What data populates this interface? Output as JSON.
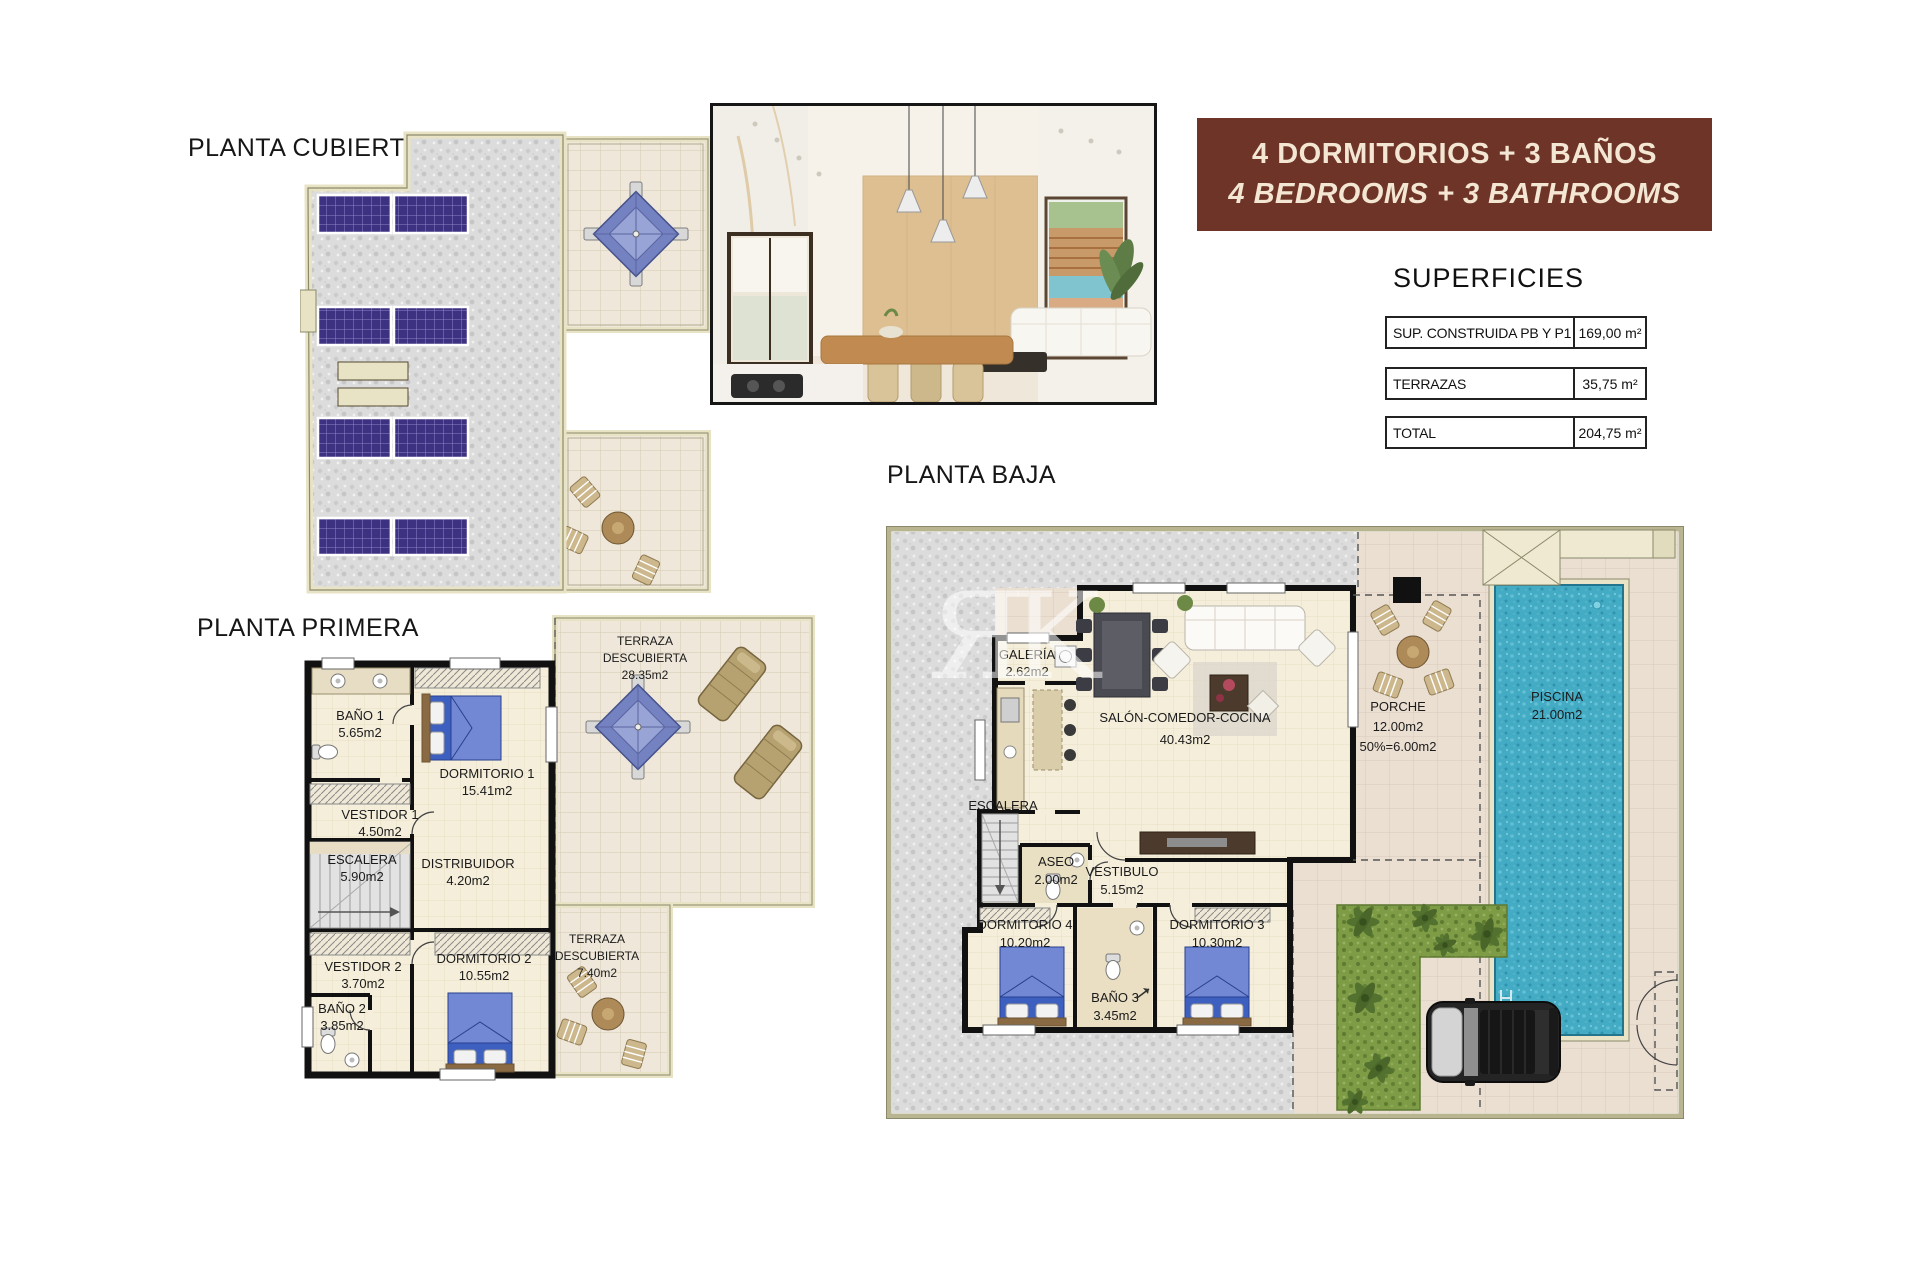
{
  "titles": {
    "cubierta": "PLANTA CUBIERTA",
    "primera": "PLANTA PRIMERA",
    "baja": "PLANTA BAJA",
    "superficies": "SUPERFICIES"
  },
  "banner": {
    "line1": "4 DORMITORIOS + 3 BAÑOS",
    "line2": "4 BEDROOMS + 3 BATHROOMS"
  },
  "superficies_table": {
    "rows": [
      {
        "label": "SUP. CONSTRUIDA PB Y P1",
        "value": "169,00 m²"
      },
      {
        "label": "TERRAZAS",
        "value": "35,75 m²"
      },
      {
        "label": "TOTAL",
        "value": "204,75 m²"
      }
    ]
  },
  "primera": {
    "rooms": {
      "bano1": {
        "name": "BAÑO 1",
        "area": "5.65m2"
      },
      "vestidor1": {
        "name": "VESTIDOR 1",
        "area": "4.50m2"
      },
      "dormitorio1": {
        "name": "DORMITORIO 1",
        "area": "15.41m2"
      },
      "escalera": {
        "name": "ESCALERA",
        "area": "5.90m2"
      },
      "distribuidor": {
        "name": "DISTRIBUIDOR",
        "area": "4.20m2"
      },
      "vestidor2": {
        "name": "VESTIDOR 2",
        "area": "3.70m2"
      },
      "dormitorio2": {
        "name": "DORMITORIO 2",
        "area": "10.55m2"
      },
      "bano2": {
        "name": "BAÑO 2",
        "area": "3.85m2"
      },
      "terraza_grande": {
        "line1": "TERRAZA",
        "line2": "DESCUBIERTA",
        "area": "28.35m2"
      },
      "terraza_pequena": {
        "line1": "TERRAZA",
        "line2": "DESCUBIERTA",
        "area": "7.40m2"
      }
    }
  },
  "baja": {
    "rooms": {
      "galeria": {
        "name": "GALERÍA",
        "area": "2.62m2"
      },
      "salon": {
        "name": "SALÓN-COMEDOR-COCINA",
        "area": "40.43m2"
      },
      "porche": {
        "name": "PORCHE",
        "area": "12.00m2",
        "area2": "50%=6.00m2"
      },
      "piscina": {
        "name": "PISCINA",
        "area": "21.00m2"
      },
      "escalera": {
        "name": "ESCALERA"
      },
      "aseo": {
        "name": "ASEO",
        "area": "2.00m2"
      },
      "vestibulo": {
        "name": "VESTIBULO",
        "area": "5.15m2"
      },
      "dormitorio4": {
        "name": "DORMITORIO 4",
        "area": "10.20m2"
      },
      "bano3": {
        "name": "BAÑO 3",
        "area": "3.45m2"
      },
      "dormitorio3": {
        "name": "DORMITORIO 3",
        "area": "10.30m2"
      }
    }
  },
  "watermark": "ЯK",
  "colors": {
    "banner_bg": "#6F3428",
    "banner_text": "#F3E6D2",
    "solar_panel": "#3D3182",
    "pool_water": "#44ABC4",
    "garden_green": "#7E9B46",
    "wall_black": "#111111",
    "wall_beige": "#E8E3C4",
    "floor_cream": "#F4EEDB",
    "gravel": "#DCDCDC",
    "patio_tile": "#EBDFD2",
    "bed_blue": "#3D5FC0"
  }
}
